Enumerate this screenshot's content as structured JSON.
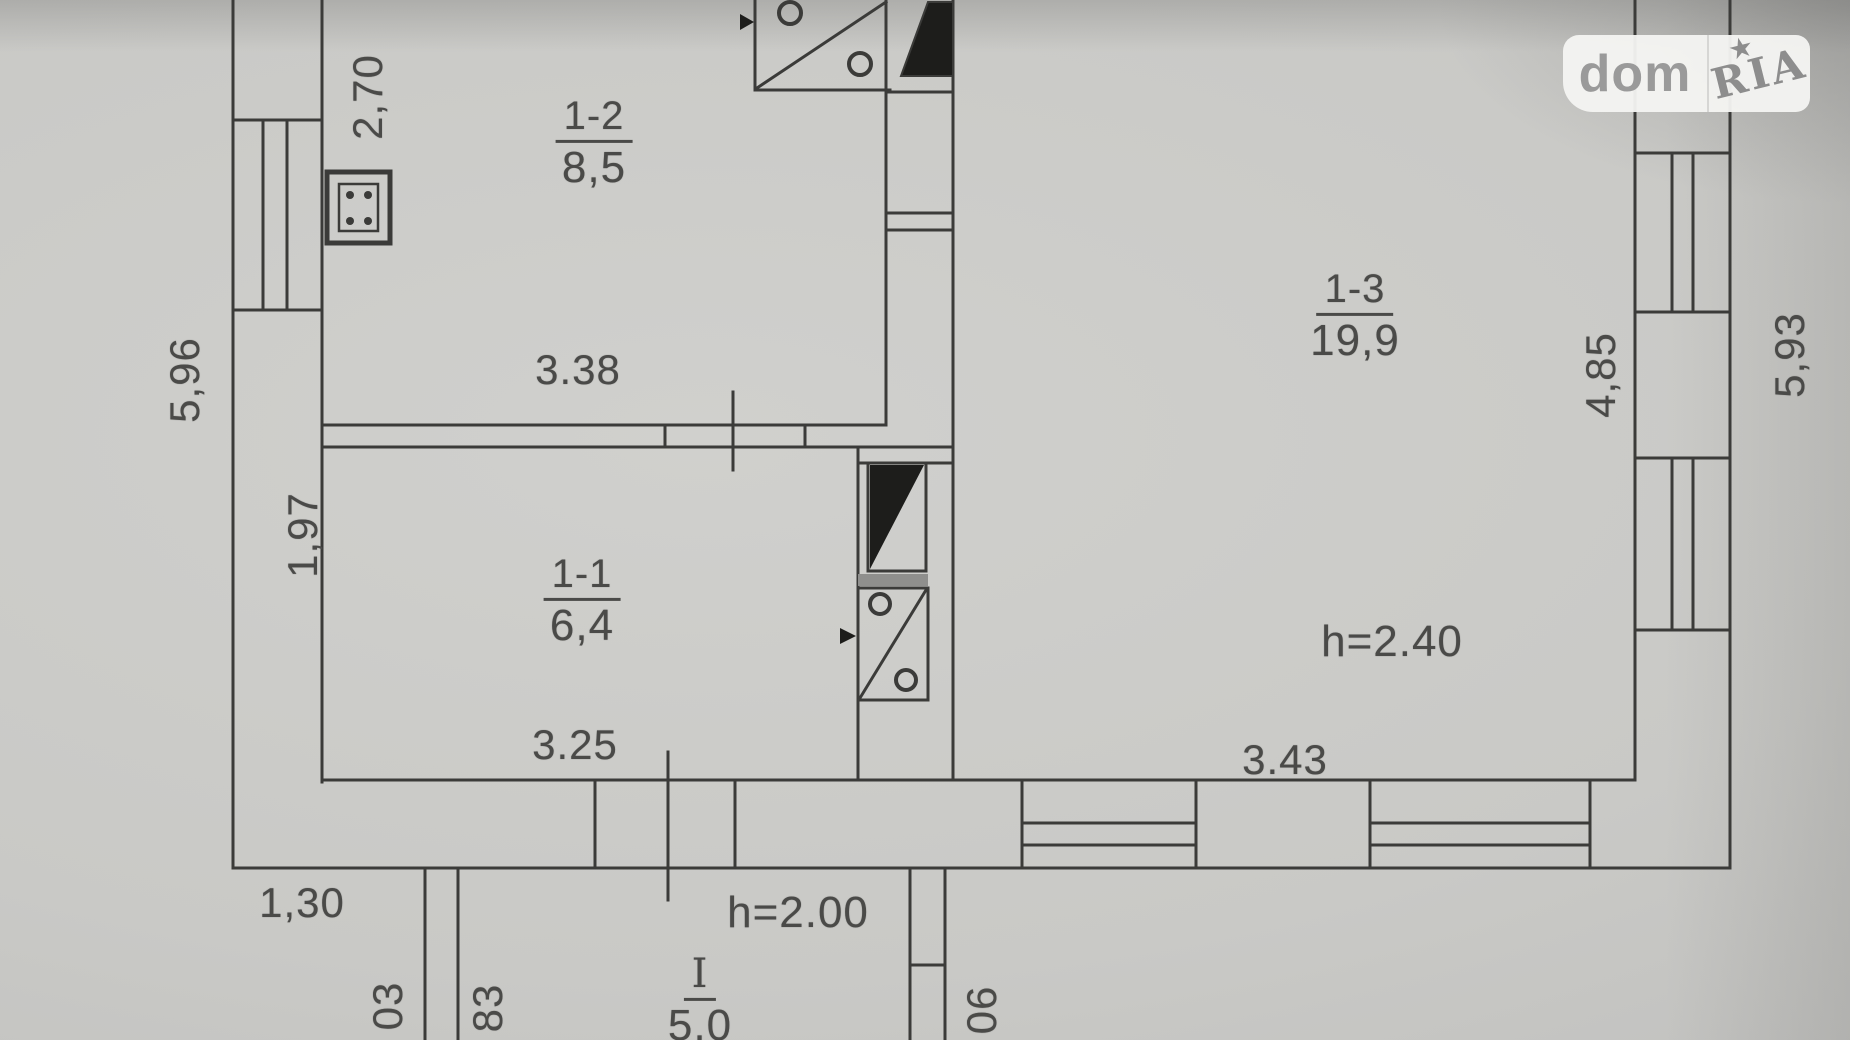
{
  "logo": {
    "left": "dom",
    "right": "RIA",
    "star": "★"
  },
  "rooms": {
    "r12": {
      "number": "1-2",
      "area": "8,5"
    },
    "r13": {
      "number": "1-3",
      "area": "19,9"
    },
    "r11": {
      "number": "1-1",
      "area": "6,4"
    },
    "porch": {
      "number": "I",
      "area": "5,0"
    }
  },
  "heights": {
    "room13": "h=2.40",
    "porch": "h=2.00"
  },
  "dims": {
    "top_left_vertical": "2,70",
    "left_outer": "5,96",
    "room12_width": "3.38",
    "room11_left": "1,97",
    "room11_width": "3.25",
    "bottom_left": "1,30",
    "room13_width": "3.43",
    "right_inner": "4,85",
    "right_outer": "5,93",
    "porch_left_a": "03",
    "porch_left_b": "83",
    "porch_right": "06"
  },
  "colors": {
    "paper": "#c9c9c6",
    "line": "#3b3b39",
    "text": "#4a4a48",
    "logo_bg": "#f4f4f2",
    "logo_text": "#9a9a9a"
  }
}
